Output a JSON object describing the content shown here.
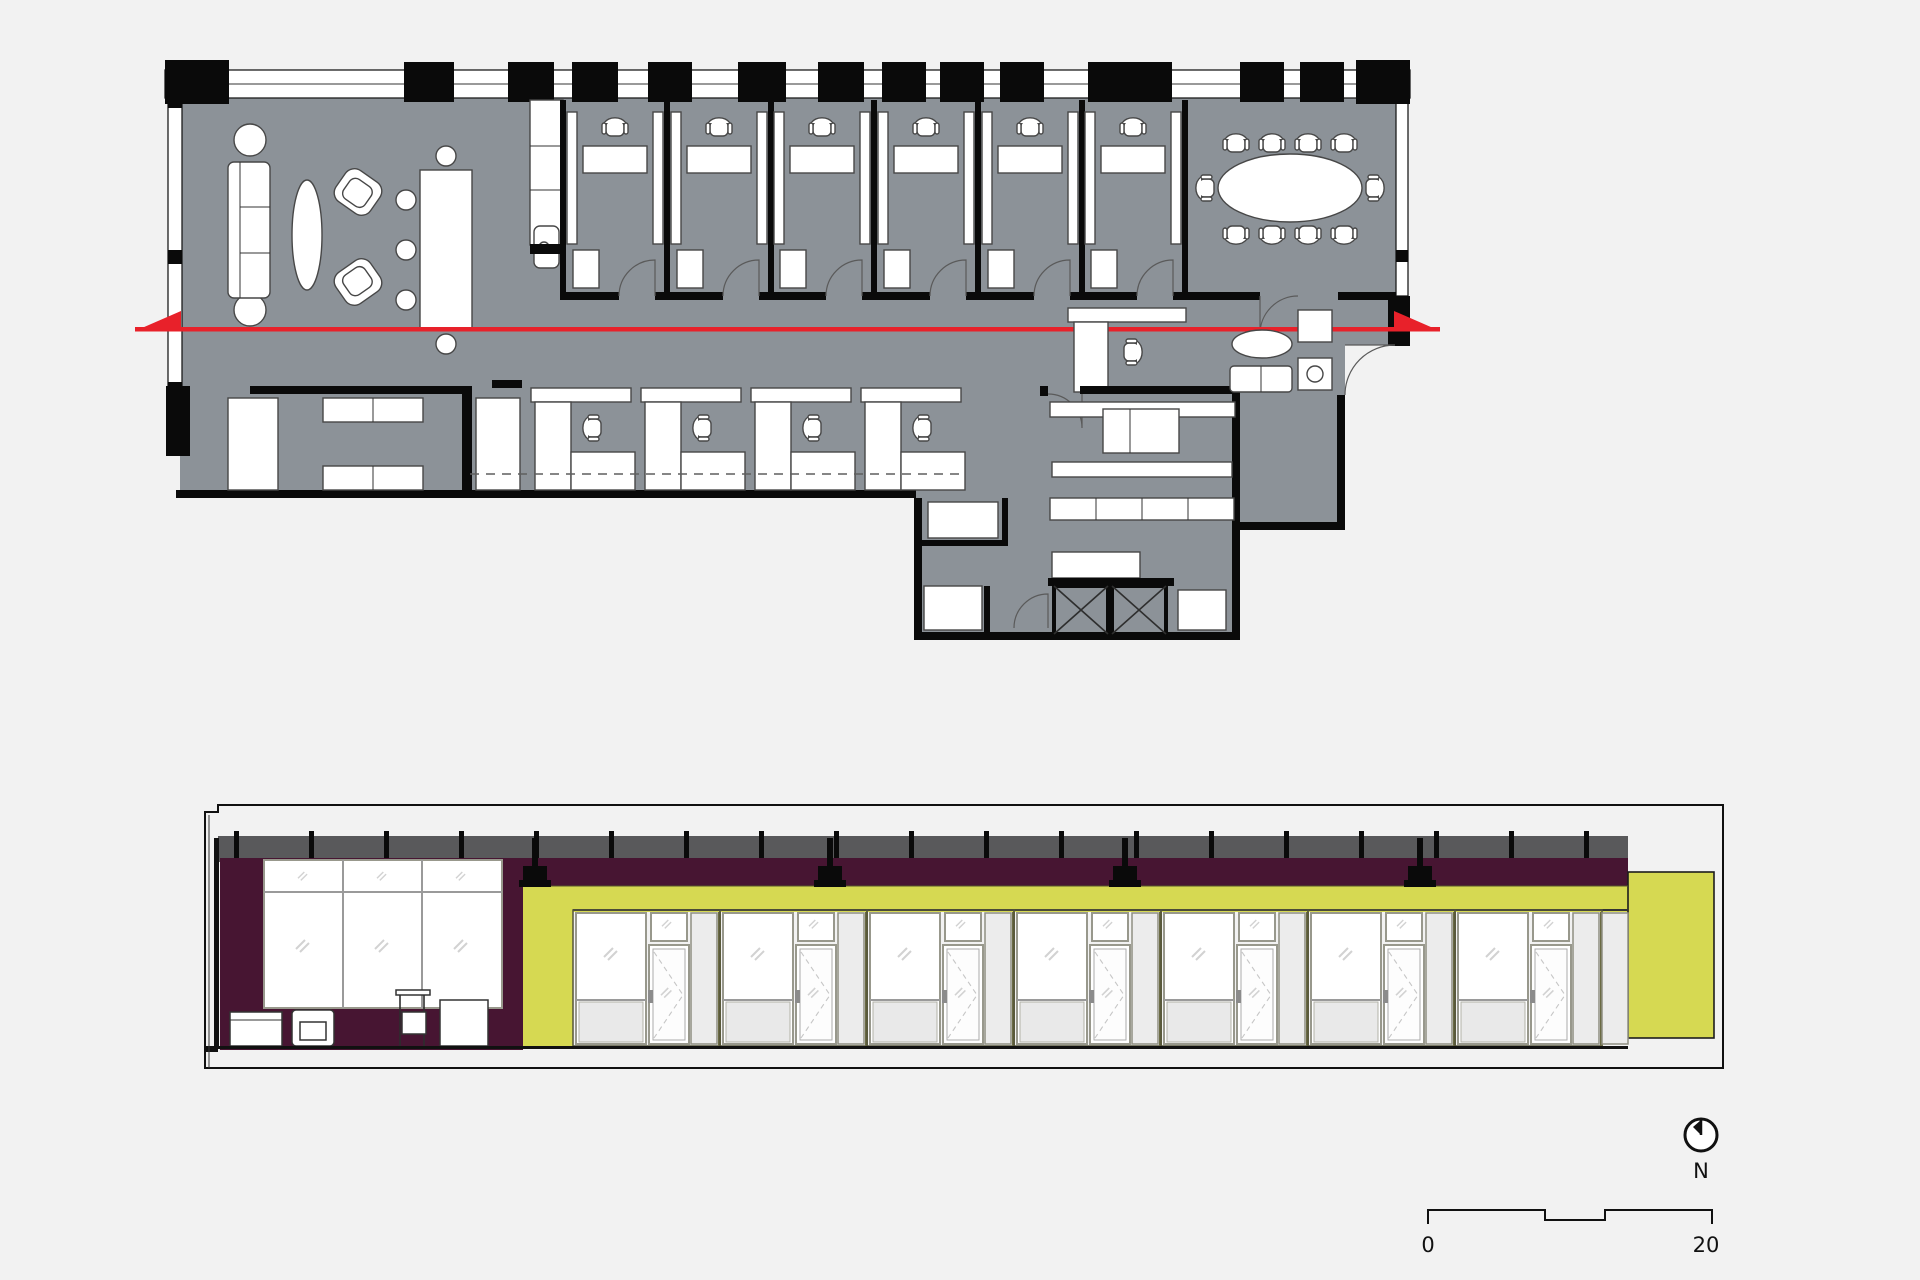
{
  "css_vars": {
    "bg": "#f2f2f2",
    "plan-floor": "#8c9298",
    "plan-wall": "#0a0a0a",
    "cut-red": "#e8212a",
    "plenum": "#59595b",
    "purple": "#471532",
    "yellow": "#d6d952",
    "panel": "#ececec",
    "ink": "#111111"
  },
  "compass": {
    "label": "N"
  },
  "scale_bar": {
    "start_label": "0",
    "end_label": "20"
  }
}
